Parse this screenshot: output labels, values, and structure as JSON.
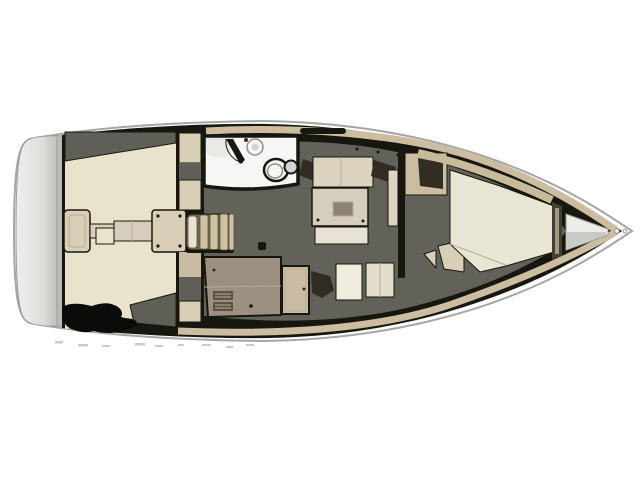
{
  "diagram": {
    "label": "sailboat-interior-deck-plan",
    "orientation": "bow-right",
    "regions": [
      {
        "id": "swim-platform"
      },
      {
        "id": "cockpit"
      },
      {
        "id": "helm-pedestal"
      },
      {
        "id": "cockpit-table"
      },
      {
        "id": "companionway-steps"
      },
      {
        "id": "head-compartment"
      },
      {
        "id": "toilet"
      },
      {
        "id": "sink"
      },
      {
        "id": "saloon"
      },
      {
        "id": "saloon-settee"
      },
      {
        "id": "saloon-table"
      },
      {
        "id": "galley-with-stove"
      },
      {
        "id": "nav-station"
      },
      {
        "id": "aft-cabin-door"
      },
      {
        "id": "forward-cabin"
      },
      {
        "id": "v-berth"
      },
      {
        "id": "anchor-locker"
      },
      {
        "id": "bow-fitting"
      }
    ]
  },
  "colors": {
    "bg": "#ffffff",
    "hull_fill": "#fcfcfb",
    "hull_stroke": "#a6a6a2",
    "hull_inner_line": "#d8d8d4",
    "transom_light": "#eeeeec",
    "transom_mid": "#dededb",
    "transom_dark": "#b4b4b1",
    "outline_black": "#17160f",
    "floor_charcoal": "#63625a",
    "wedge_charcoal": "#5f5e57",
    "deck_tan": "#ccbda0",
    "cockpit_cream": "#e9e2cd",
    "furniture_beige": "#d9cfb6",
    "cushion_beige": "#dcd3c0",
    "bench_cream": "#e7e2d3",
    "table_beige": "#d6cebd",
    "table_inset": "#8b8375",
    "bed_cream": "#e9e6d6",
    "shelf_tan": "#c9ba9c",
    "galley_taupe": "#9e9081",
    "burner_dark": "#5c5346",
    "steps_base": "#6e6450",
    "steps_slat": "#cfc2a4",
    "steps_slat_edge": "#5f563f",
    "door_beige": "#c9bca2",
    "dark_brown": "#332c23",
    "head_white": "#f6f6f4",
    "shower_gray": "#e9e9e6",
    "fixture_gray": "#d4d4d0",
    "fixture_stroke": "#8f8f8b",
    "locker_white": "#ebebe8",
    "locker_gray": "#c9c9c5",
    "bulkhead_dark": "#453e33",
    "bulkhead_tan": "#a3977f",
    "wardrobe_tan": "#cbbda1",
    "blob_black": "#0b0b09",
    "artifact_gray": "#b5b0a8",
    "line_soft": "#b7ad94",
    "line_gray": "#9a9a96",
    "chart_cream": "#f0ebdd",
    "seat_pale": "#e3ddcc"
  }
}
